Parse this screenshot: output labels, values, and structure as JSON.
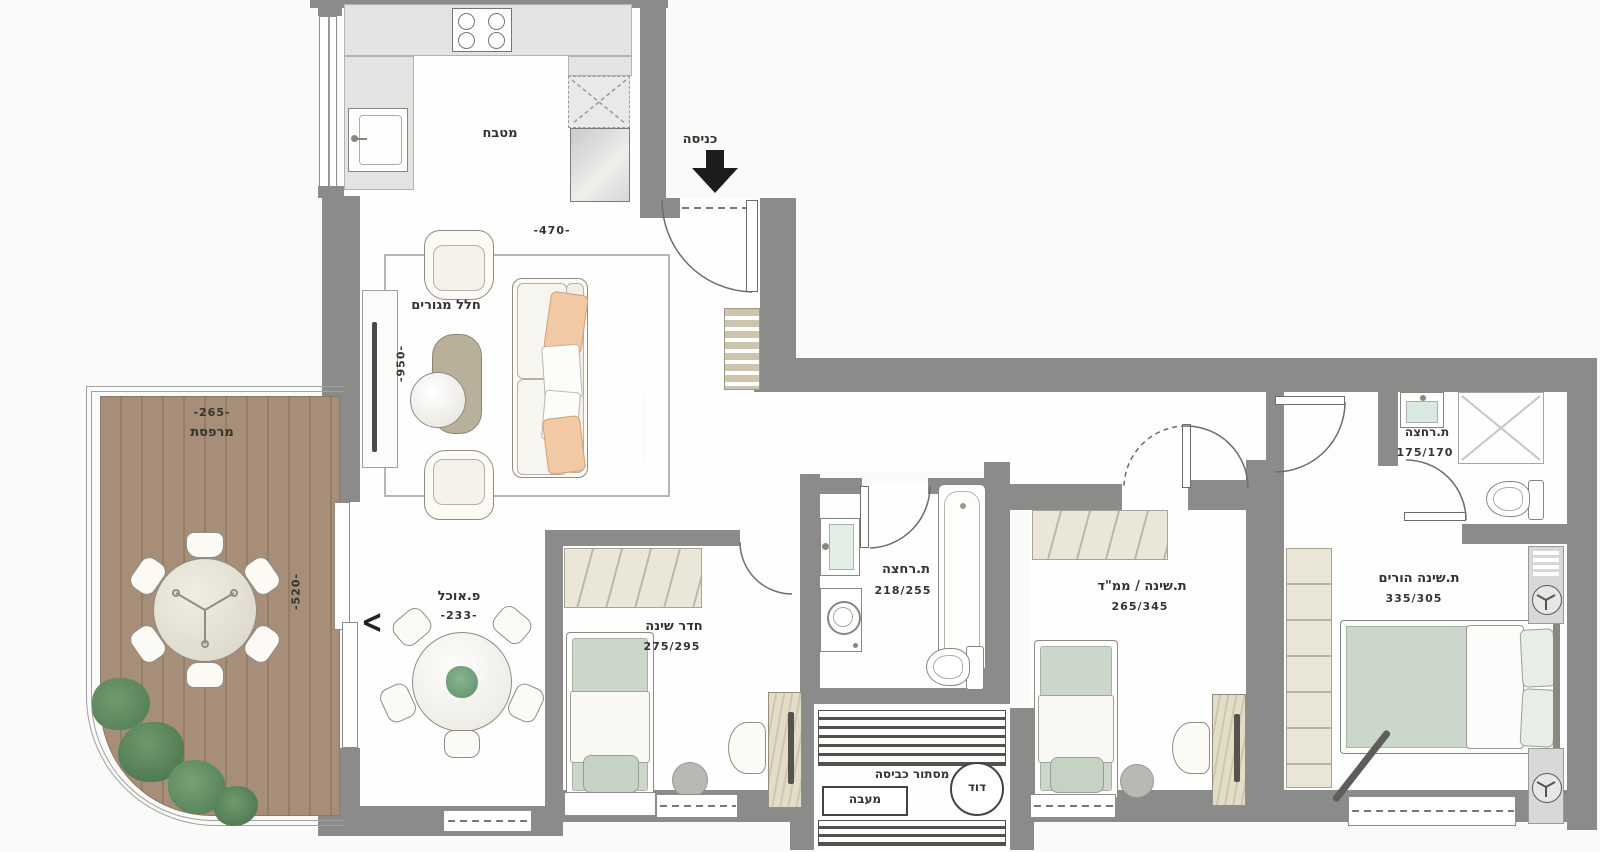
{
  "plan": {
    "entrance": {
      "label": "כניסה"
    },
    "kitchen": {
      "label": "מטבח"
    },
    "living": {
      "label": "חלל מגורים",
      "dim_width": "-470-",
      "dim_height": "-950-",
      "slider_glyph": "<"
    },
    "dining": {
      "label": "פ.אוכל",
      "dim": "-233-"
    },
    "balcony": {
      "label": "מרפסת",
      "dim_width": "-265-",
      "dim_height": "-520-"
    },
    "bedroom1": {
      "label": "חדר שינה",
      "size": "275/295"
    },
    "bathroom": {
      "label": "ת.רחצה",
      "size": "218/255"
    },
    "mamad": {
      "label": "ת.שינה / ממ\"ד",
      "size": "265/345"
    },
    "ensuite": {
      "label": "ת.רחצה",
      "size": "175/170"
    },
    "master": {
      "label": "ת.שינה הורים",
      "size": "335/305"
    },
    "laundry": {
      "label": "מסתור כביסה",
      "condenser": "מעבה",
      "boiler": "דוד"
    }
  },
  "colors": {
    "wall": "#8b8b89",
    "deck": "#a68e78",
    "deck_stripe": "#947e68",
    "mattress_sage": "#ccd7cb",
    "pillow_peach": "#f2c9a4",
    "wardrobe_beige": "#eae7d8",
    "plant_green": "#5e8b63",
    "arrow_black": "#1c1c1a"
  }
}
